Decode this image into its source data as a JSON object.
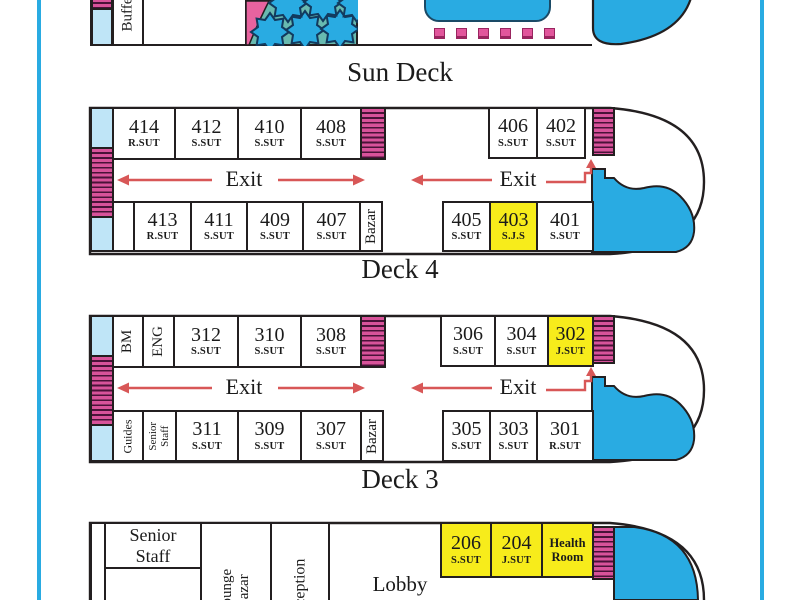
{
  "colors": {
    "ship_blue": "#29abe2",
    "light_blue": "#bfe5f7",
    "stairs_pink": "#d8539a",
    "pattern_teal": "#68bab0",
    "highlight_yellow": "#f7ec1b",
    "arrow_red": "#d85757",
    "outline_dark": "#231f20"
  },
  "sun_deck": {
    "label": "Sun Deck",
    "buffet": "Buffet"
  },
  "deck4": {
    "label": "Deck 4",
    "exit_left": "Exit",
    "exit_right": "Exit",
    "bazar": "Bazar",
    "top_rooms": [
      {
        "num": "414",
        "type": "R.SUT"
      },
      {
        "num": "412",
        "type": "S.SUT"
      },
      {
        "num": "410",
        "type": "S.SUT"
      },
      {
        "num": "408",
        "type": "S.SUT"
      },
      {
        "num": "406",
        "type": "S.SUT"
      },
      {
        "num": "402",
        "type": "S.SUT"
      }
    ],
    "bottom_rooms": [
      {
        "num": "413",
        "type": "R.SUT"
      },
      {
        "num": "411",
        "type": "S.SUT"
      },
      {
        "num": "409",
        "type": "S.SUT"
      },
      {
        "num": "407",
        "type": "S.SUT"
      },
      {
        "num": "405",
        "type": "S.SUT"
      },
      {
        "num": "403",
        "type": "S.J.S"
      },
      {
        "num": "401",
        "type": "S.SUT"
      }
    ]
  },
  "deck3": {
    "label": "Deck 3",
    "exit_left": "Exit",
    "exit_right": "Exit",
    "bazar": "Bazar",
    "crew_top": [
      "BM",
      "ENG"
    ],
    "guides": "Guides",
    "senior_staff": [
      "Senior",
      "Staff"
    ],
    "top_rooms": [
      {
        "num": "312",
        "type": "S.SUT"
      },
      {
        "num": "310",
        "type": "S.SUT"
      },
      {
        "num": "308",
        "type": "S.SUT"
      },
      {
        "num": "306",
        "type": "S.SUT"
      },
      {
        "num": "304",
        "type": "S.SUT"
      },
      {
        "num": "302",
        "type": "J.SUT"
      }
    ],
    "bottom_rooms": [
      {
        "num": "311",
        "type": "S.SUT"
      },
      {
        "num": "309",
        "type": "S.SUT"
      },
      {
        "num": "307",
        "type": "S.SUT"
      },
      {
        "num": "305",
        "type": "S.SUT"
      },
      {
        "num": "303",
        "type": "S.SUT"
      },
      {
        "num": "301",
        "type": "R.SUT"
      }
    ]
  },
  "deck2": {
    "senior_staff": [
      "Senior",
      "Staff"
    ],
    "lounge_bazar": [
      "Lounge",
      "Bazar"
    ],
    "reception": "Reception",
    "lobby": "Lobby",
    "health_room": [
      "Health",
      "Room"
    ],
    "rooms": [
      {
        "num": "206",
        "type": "S.SUT"
      },
      {
        "num": "204",
        "type": "J.SUT"
      }
    ]
  }
}
